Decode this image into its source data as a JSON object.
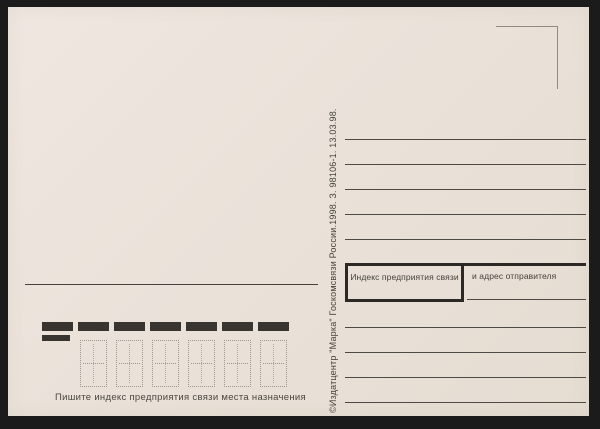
{
  "postcard": {
    "imprint": "©Издатцентр \"Марка\" Госкомсвязи России.1998. З. 98106-1. 13.03.98.",
    "sender_index_label": "Индекс предприятия связи",
    "sender_address_label": "и адрес отправителя",
    "index_hint": "Пишите индекс предприятия связи места назначения",
    "counts": {
      "address_lines_top": 5,
      "address_lines_bottom": 4,
      "index_bars": 7,
      "index_digit_cells": 6
    },
    "colors": {
      "card_background": "#eae2d9",
      "scan_frame": "#1b1b1b",
      "writing_line": "#4d4a46",
      "thick_rule": "#2b2825",
      "ink": "#44403b",
      "stencil_dots": "#a2958a"
    }
  }
}
